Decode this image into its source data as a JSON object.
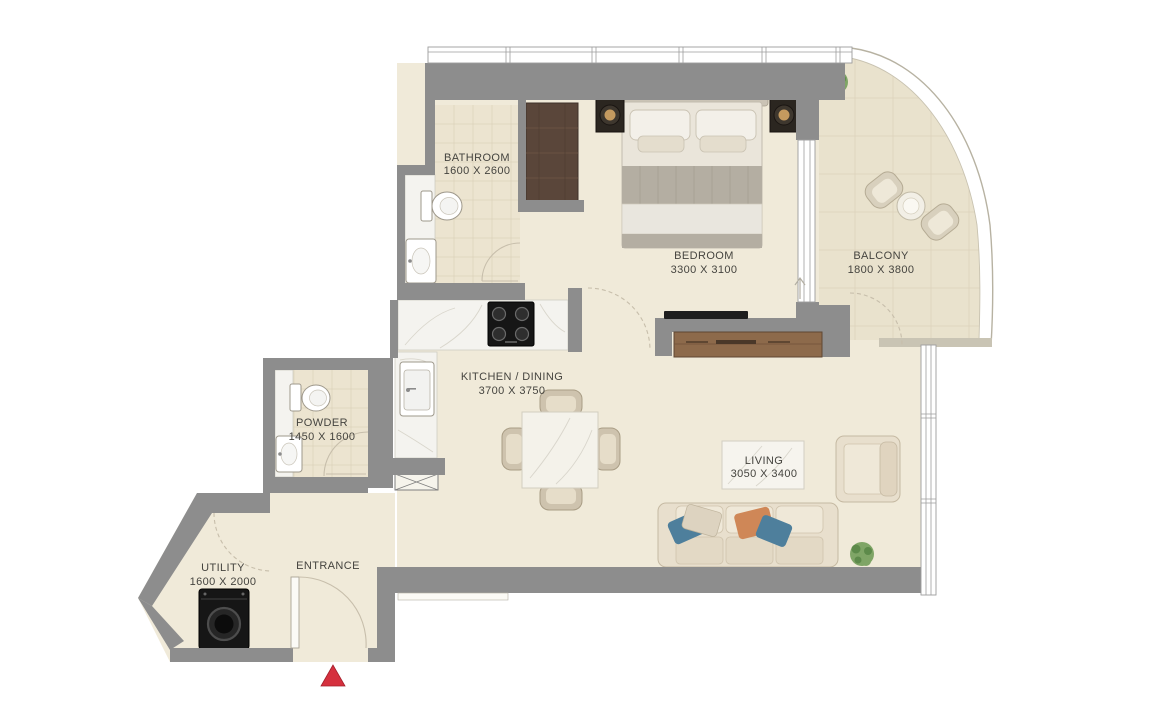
{
  "plan": {
    "title": "1 Bedroom Apartment Floor Plan",
    "rooms": [
      {
        "id": "bathroom",
        "name": "BATHROOM",
        "dims": "1600 X 2600"
      },
      {
        "id": "bedroom",
        "name": "BEDROOM",
        "dims": "3300 X 3100"
      },
      {
        "id": "balcony",
        "name": "BALCONY",
        "dims": "1800 X 3800"
      },
      {
        "id": "kitchen-dining",
        "name": "KITCHEN / DINING",
        "dims": "3700 X 3750"
      },
      {
        "id": "powder",
        "name": "POWDER",
        "dims": "1450 X 1600"
      },
      {
        "id": "living",
        "name": "LIVING",
        "dims": "3050 X 3400"
      },
      {
        "id": "utility",
        "name": "UTILITY",
        "dims": "1600 X 2000"
      },
      {
        "id": "entrance",
        "name": "ENTRANCE",
        "dims": ""
      }
    ],
    "colors": {
      "wall": "#8d8d8d",
      "floor": "#f0ead9",
      "tile": "#ece4d0",
      "balcony_floor": "#e9e2cd",
      "grid": "#dbd2ba",
      "marble": "#f4f3ef",
      "arc": "#c7beab",
      "wood_dark": "#5a463a",
      "wood_medium": "#8d6a4b",
      "marker_red": "#d5303e",
      "label": "#45443f"
    },
    "furniture": [
      "double-bed",
      "nightstand",
      "table-lamp",
      "wardrobe",
      "tv",
      "tv-console",
      "sofa",
      "armchair",
      "coffee-table",
      "dining-table",
      "dining-chair",
      "cooktop",
      "kitchen-sink",
      "toilet",
      "washbasin",
      "washing-machine",
      "balcony-chair",
      "balcony-table",
      "plant"
    ]
  }
}
